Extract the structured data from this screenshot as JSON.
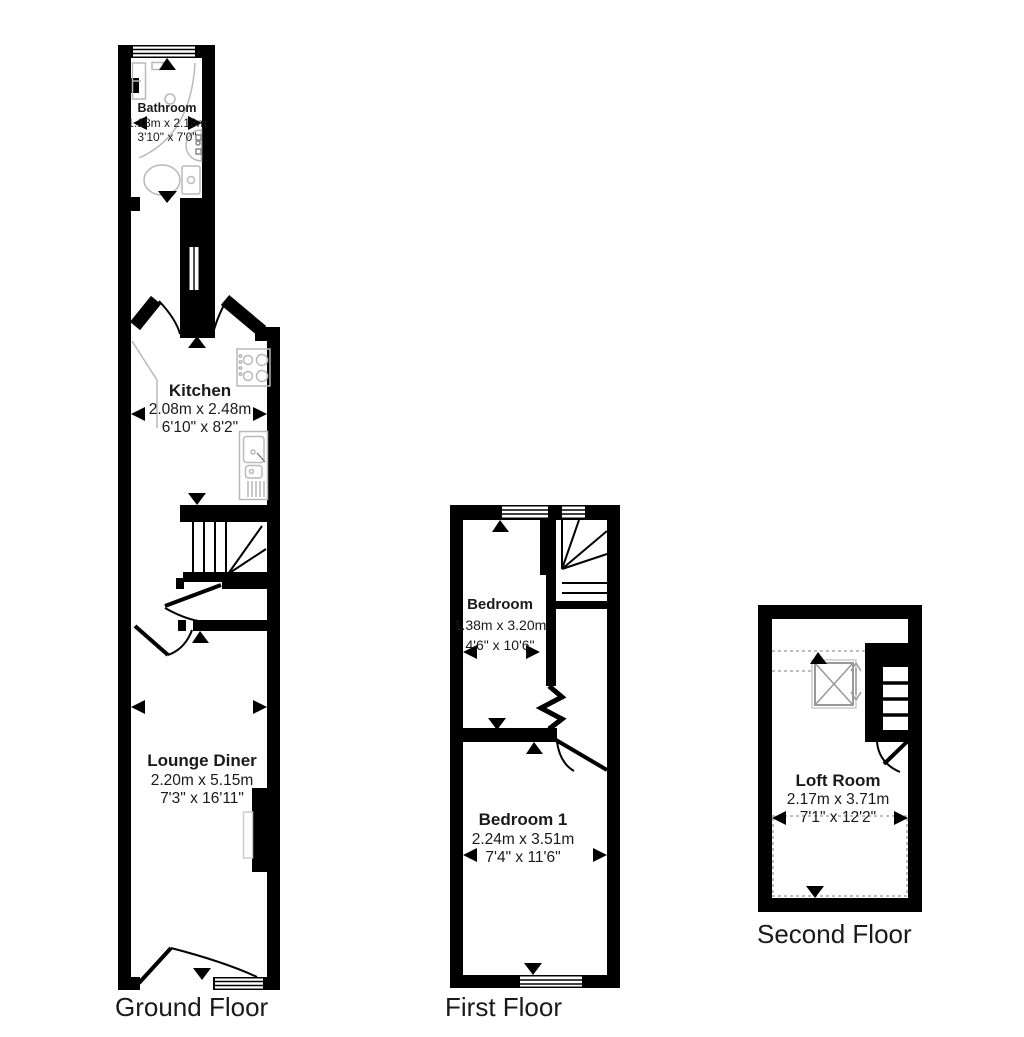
{
  "floors": [
    {
      "label": "Ground Floor",
      "rooms": [
        {
          "name": "Bathroom",
          "metric": "1.18m x 2.13m",
          "imperial": "3'10\" x 7'0\""
        },
        {
          "name": "Kitchen",
          "metric": "2.08m x 2.48m",
          "imperial": "6'10\" x 8'2\""
        },
        {
          "name": "Lounge Diner",
          "metric": "2.20m x 5.15m",
          "imperial": "7'3\" x 16'11\""
        }
      ]
    },
    {
      "label": "First Floor",
      "rooms": [
        {
          "name": "Bedroom",
          "metric": "1.38m x 3.20m",
          "imperial": "4'6\" x 10'6\""
        },
        {
          "name": "Bedroom 1",
          "metric": "2.24m x 3.51m",
          "imperial": "7'4\" x 11'6\""
        }
      ]
    },
    {
      "label": "Second Floor",
      "rooms": [
        {
          "name": "Loft Room",
          "metric": "2.17m x 3.71m",
          "imperial": "7'1\" x 12'2\""
        }
      ]
    }
  ],
  "colors": {
    "wall": "#000000",
    "fixture": "#b9b9b9",
    "dashed": "#aaaaaa",
    "background": "#ffffff"
  }
}
